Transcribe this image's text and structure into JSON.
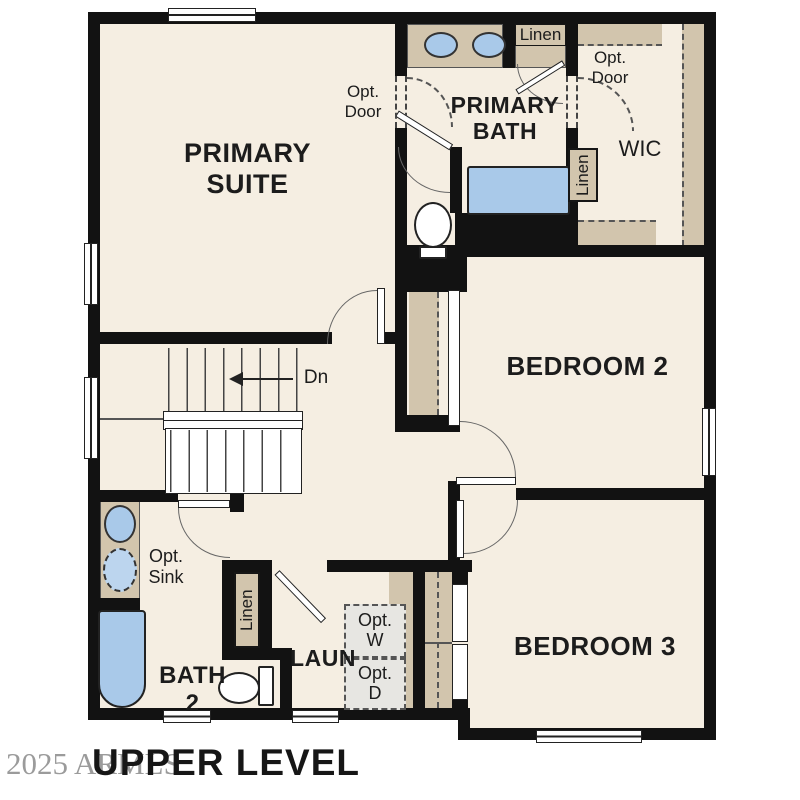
{
  "title": "UPPER LEVEL",
  "watermark": "2025 ARMLS",
  "rooms": {
    "primary_suite": "PRIMARY SUITE",
    "primary_bath": "PRIMARY BATH",
    "wic": "WIC",
    "bedroom2": "BEDROOM 2",
    "bedroom3": "BEDROOM 3",
    "bath2": "BATH 2",
    "laundry": "LAUN"
  },
  "annotations": {
    "linen_top": "Linen",
    "linen_wic": "Linen",
    "linen_hall": "Linen",
    "opt_door_bath": "Opt. Door",
    "opt_door_wic": "Opt. Door",
    "opt_sink": "Opt. Sink",
    "opt_washer": "Opt. W",
    "opt_dryer": "Opt. D",
    "stairs_down": "Dn"
  },
  "colors": {
    "floor": "#f5eee2",
    "wall": "#121212",
    "fixture_tan": "#d2c5ad",
    "fixture_blue": "#a9c9e9",
    "optional_gray": "#e7e6e2",
    "watermark_gray": "#9b9b9b"
  }
}
